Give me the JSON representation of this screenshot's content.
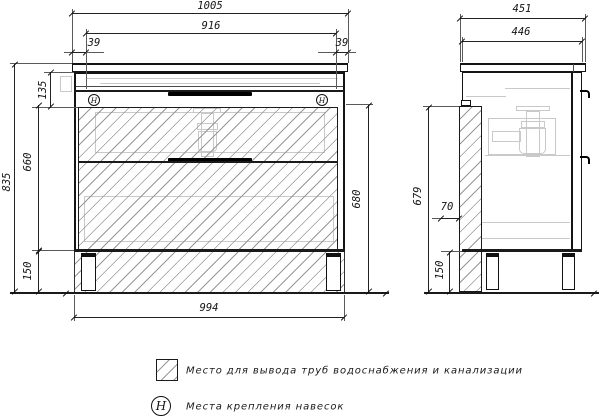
{
  "drawing": {
    "front_view": {
      "dim_width_total": "1005",
      "dim_width_inner": "916",
      "dim_offset_left": "39",
      "dim_offset_right": "39",
      "dim_height_total": "835",
      "dim_counter_to_body": "135",
      "dim_body_height": "660",
      "dim_legs_height": "150",
      "dim_inner_height": "680",
      "dim_base_width": "994",
      "hinge_mark": "H"
    },
    "side_view": {
      "dim_depth_total": "451",
      "dim_depth_body": "446",
      "dim_back_clear_height": "679",
      "dim_pipe_zone_depth": "70",
      "dim_legs_height": "150"
    },
    "legend": {
      "hatch_symbol_text": "Место для вывода труб водоснабжения и канализации",
      "hinge_symbol": "H",
      "hinge_symbol_text": "Места крепления навесок"
    },
    "colors": {
      "line": "#1a1a1a",
      "hatch_line": "#979797",
      "ghost_line": "#c9c9c9",
      "background": "#ffffff"
    }
  }
}
